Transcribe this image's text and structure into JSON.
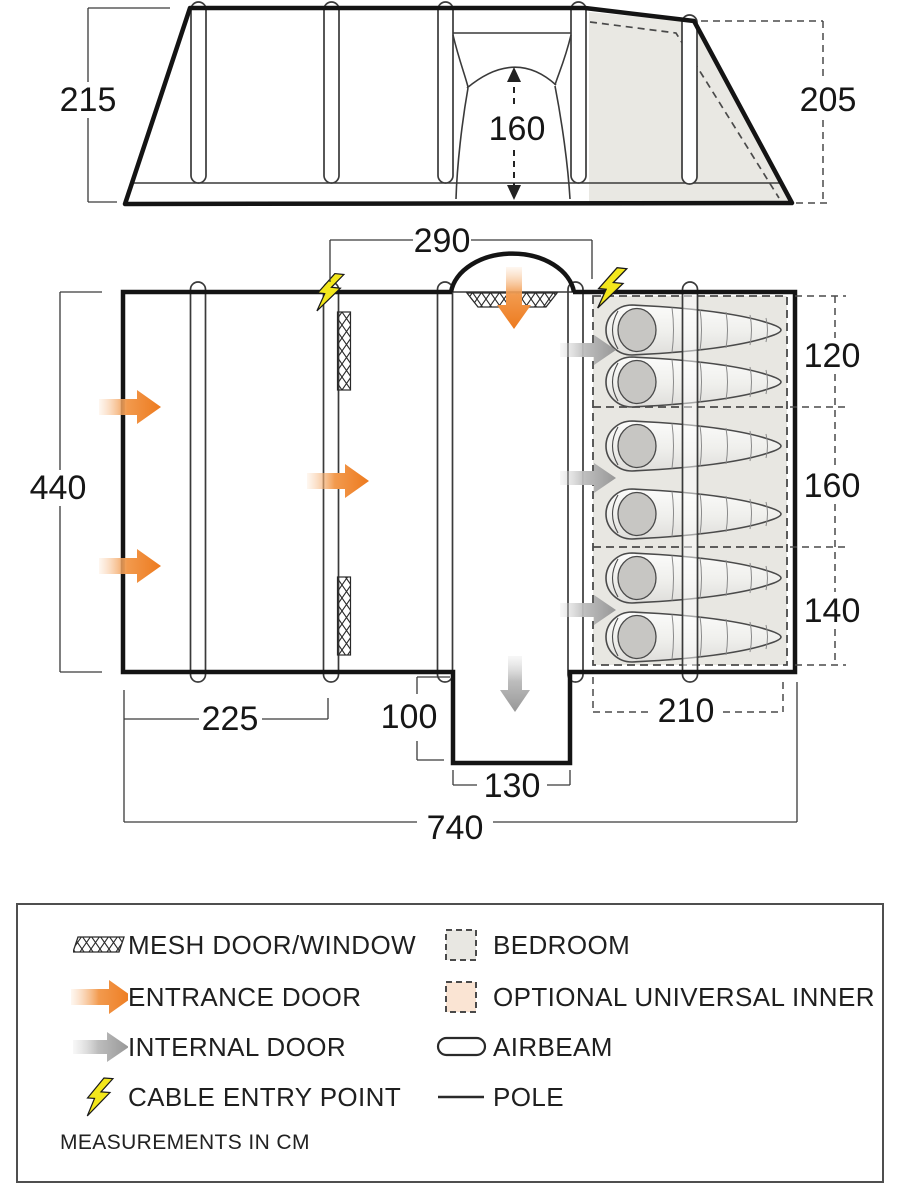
{
  "diagram_title": "tent-floorplan-diagram",
  "colors": {
    "outline": "#141414",
    "entrance_door": "#ed7a1e",
    "internal_door": "#9b9b9b",
    "cable_entry": "#f3e71c",
    "bedroom_fill": "#e8e7e2",
    "optional_inner_fill": "#fae4d3"
  },
  "elevation": {
    "front_height": "215",
    "rear_height": "205",
    "door_height": "160"
  },
  "plan": {
    "living_width": "290",
    "depth": "440",
    "bedroom_sections": [
      "120",
      "160",
      "140"
    ],
    "front_width": "225",
    "porch_depth": "100",
    "porch_width": "130",
    "bedroom_depth": "210",
    "total_width": "740"
  },
  "legend": {
    "items_left": [
      {
        "label": "MESH DOOR/WINDOW",
        "icon": "mesh-swatch"
      },
      {
        "label": "ENTRANCE DOOR",
        "icon": "entrance-arrow"
      },
      {
        "label": "INTERNAL DOOR",
        "icon": "internal-arrow"
      },
      {
        "label": "CABLE ENTRY POINT",
        "icon": "lightning-bolt"
      }
    ],
    "items_right": [
      {
        "label": "BEDROOM",
        "icon": "bedroom-swatch"
      },
      {
        "label": "OPTIONAL UNIVERSAL INNER",
        "icon": "optional-inner-swatch"
      },
      {
        "label": "AIRBEAM",
        "icon": "airbeam"
      },
      {
        "label": "POLE",
        "icon": "pole"
      }
    ],
    "note": "MEASUREMENTS IN CM"
  }
}
